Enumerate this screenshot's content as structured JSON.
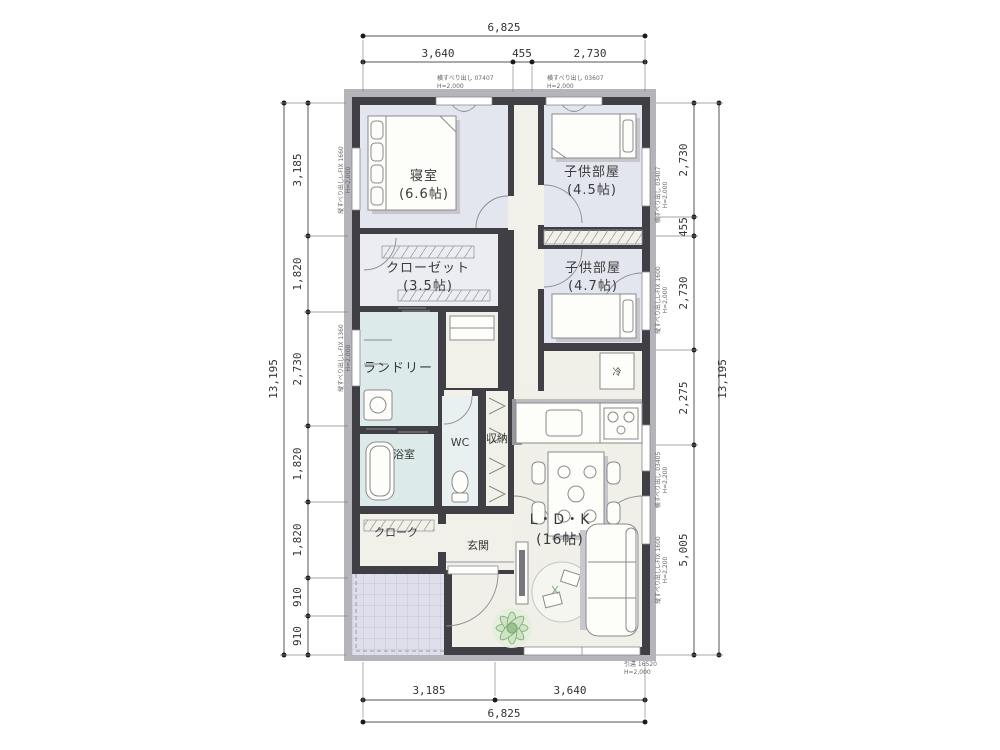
{
  "plan": {
    "rooms": {
      "bedroom": {
        "name": "寝室",
        "size": "(6.6帖)"
      },
      "kids1": {
        "name": "子供部屋",
        "size": "(4.5帖)"
      },
      "kids2": {
        "name": "子供部屋",
        "size": "(4.7帖)"
      },
      "closet": {
        "name": "クローゼット",
        "size": "(3.5帖)"
      },
      "laundry": {
        "name": "ランドリー"
      },
      "bath": {
        "name": "浴室"
      },
      "wc": {
        "name": "WC"
      },
      "storage": {
        "name": "収納"
      },
      "cloak": {
        "name": "クローク"
      },
      "genkan": {
        "name": "玄関"
      },
      "ldk": {
        "name": "L・D・K",
        "size": "(16帖)"
      },
      "fridge": {
        "name": "冷"
      }
    },
    "dims": {
      "top": {
        "overall": "6,825",
        "segments": [
          "3,640",
          "455",
          "2,730"
        ]
      },
      "bottom": {
        "overall": "6,825",
        "segments": [
          "3,185",
          "3,640"
        ]
      },
      "left": {
        "overall": "13,195",
        "segments": [
          "3,185",
          "1,820",
          "2,730",
          "1,820",
          "1,820",
          "910",
          "910"
        ]
      },
      "right": {
        "overall": "13,195",
        "segments": [
          "2,730",
          "455",
          "2,730",
          "2,275",
          "5,005"
        ]
      }
    },
    "windows": {
      "top_left": {
        "text": "横すべり出し 07407",
        "height": "H=2,000"
      },
      "top_right": {
        "text": "横すべり出し 03607",
        "height": "H=2,000"
      },
      "left_bedroom": {
        "text": "縦すべり出しL-FIX 1660",
        "height": "H=2,000"
      },
      "left_laundry": {
        "text": "縦すべり出しL-FIX 1360",
        "height": "H=2,000"
      },
      "right_kids1": {
        "text": "横すべり出し 03407",
        "height": "H=2,000"
      },
      "right_kids2": {
        "text": "縦すべり出しL-FIX 1600",
        "height": "H=2,000"
      },
      "right_ldk_upper": {
        "text": "横すべり出し 03405",
        "height": "H=2,200"
      },
      "right_ldk_lower": {
        "text": "縦すべり出しL-FIX 1600",
        "height": "H=2,200"
      },
      "bottom_ldk": {
        "text": "引違 16520",
        "height": "H=2,000"
      }
    },
    "colors": {
      "wall": "#3f3f45",
      "roof_shadow": "#b4b4b9",
      "bedroom_floor": "#e4e6ef",
      "wet_floor": "#dcebea",
      "ldk_floor": "#f0efe8",
      "hall_floor": "#f1f1ea",
      "porch_floor": "#dfdfec",
      "plant_green": "#7aa86f"
    }
  }
}
